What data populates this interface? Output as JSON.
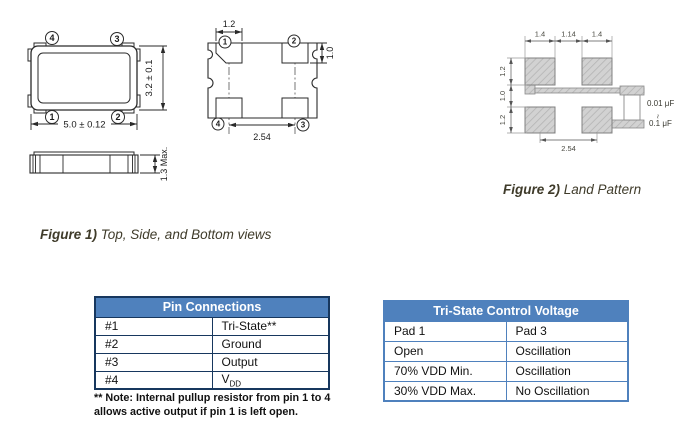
{
  "colors": {
    "table_header_bg": "#4f81bd",
    "table_header_text": "#ffffff",
    "pin_table_border": "#17375e",
    "tristate_table_border": "#4f81bd",
    "caption_text": "#3f3b2a",
    "drawing_line": "#2a2a2a",
    "land_pad_fill": "#d2d2d2"
  },
  "figure1": {
    "caption_prefix": "Figure 1)",
    "caption_text": " Top, Side, and Bottom views",
    "top_view": {
      "width_dim": "5.0 ± 0.12",
      "height_dim": "3.2 ± 0.1",
      "pin_top_left": "4",
      "pin_top_right": "3",
      "pin_bottom_left": "1",
      "pin_bottom_right": "2"
    },
    "bottom_view": {
      "pad_width_dim": "1.2",
      "pad_height_dim": "1.0",
      "pitch_dim": "2.54",
      "pin_top_left": "1",
      "pin_top_right": "2",
      "pin_bottom_left": "4",
      "pin_bottom_right": "3"
    },
    "side_view": {
      "height_dim": "1.3 Max."
    }
  },
  "figure2": {
    "caption_prefix": "Figure 2)",
    "caption_text": " Land Pattern",
    "dim_pad_width_left": "1.4",
    "dim_pad_gap": "1.14",
    "dim_pad_width_right": "1.4",
    "dim_pad_height_top": "1.2",
    "dim_row_gap": "1.0",
    "dim_pad_height_bottom": "1.2",
    "dim_pitch": "2.54",
    "cap_min": "0.01 μF",
    "cap_range": "~",
    "cap_max": "0.1 μF"
  },
  "pin_table": {
    "title": "Pin Connections",
    "rows": [
      {
        "pin": "#1",
        "func": "Tri-State**"
      },
      {
        "pin": "#2",
        "func": "Ground"
      },
      {
        "pin": "#3",
        "func": "Output"
      },
      {
        "pin": "#4",
        "func": "V",
        "func_sub": "DD"
      }
    ],
    "note_line1": "** Note: Internal pullup resistor from pin 1 to 4",
    "note_line2": "allows active output if pin 1 is left open."
  },
  "tristate_table": {
    "title": "Tri-State Control Voltage",
    "rows": [
      {
        "pad1": "Pad 1",
        "pad3": "Pad 3"
      },
      {
        "pad1": "Open",
        "pad3": "Oscillation"
      },
      {
        "pad1": "70% VDD Min.",
        "pad3": "Oscillation"
      },
      {
        "pad1": "30% VDD Max.",
        "pad3": "No Oscillation"
      }
    ]
  }
}
